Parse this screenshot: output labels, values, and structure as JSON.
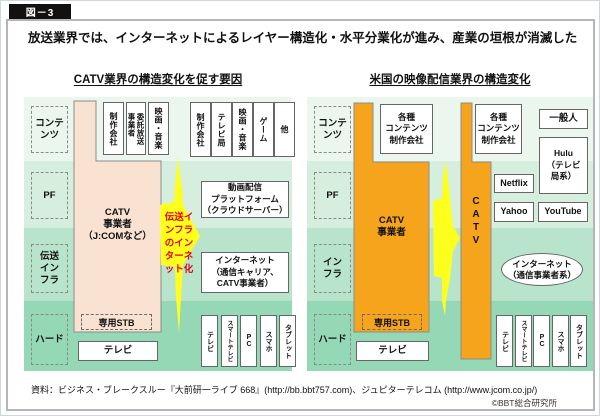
{
  "badge_label": "図－3",
  "title": "放送業界では、インターネットによるレイヤー構造化・水平分業化が進み、産業の垣根が消滅した",
  "colors": {
    "band-content": "#eaf6ee",
    "band-pf": "#d6eede",
    "band-infra": "#b9e4cc",
    "band-hard": "#95d8b5",
    "catv-japan": "#f9e2d1",
    "catv-us": "#f6a41c",
    "arrow": "#ffff1e",
    "arrow-text": "#e60012",
    "badge-bg": "#111111"
  },
  "left_panel": {
    "heading": "CATV業界の構造変化を促す要因",
    "layers": [
      "コンテ\nンツ",
      "PF",
      "伝送\nイン\nフラ",
      "ハード"
    ],
    "boxes_over_catv": [
      "制作会社",
      "委託放送\n事業者",
      "映画・音楽"
    ],
    "content_boxes": [
      "制作会社",
      "テレビ局",
      "映画・音楽",
      "ゲーム",
      "他"
    ],
    "catv_label": "CATV\n事業者\n（J:COMなど）",
    "pf_box": "動画配信\nプラットフォーム\n（クラウドサーバー）",
    "infra_box": "インターネット\n（通信キャリア、\nCATV事業者）",
    "arrow_label": "伝送イ\nンフラ\nのイン\nターネ\nット化",
    "stb_label": "専用STB",
    "tv_label": "テレビ",
    "hard_boxes": [
      "テレビ",
      "スマートテレビ",
      "PC",
      "スマホ",
      "タブレット"
    ]
  },
  "right_panel": {
    "heading": "米国の映像配信業界の構造変化",
    "layers": [
      "コンテ\nンツ",
      "PF",
      "イン\nフラ",
      "ハード"
    ],
    "content_boxes": [
      "各種\nコンテンツ\n制作会社",
      "各種\nコンテンツ\n制作会社",
      "一般人"
    ],
    "catv_label": "CATV\n事業者",
    "catv_bar_label": "CATV",
    "hulu": "Hulu\n（テレビ\n局系）",
    "netflix": "Netflix",
    "yahoo": "Yahoo",
    "youtube": "YouTube",
    "internet_ellipse": "インターネット\n（通信事業者系）",
    "stb_label": "専用STB",
    "tv_label": "テレビ",
    "hard_boxes": [
      "テレビ",
      "スマートテレビ",
      "PC",
      "スマホ",
      "タブレット"
    ]
  },
  "footer": {
    "source": "資料：ビジネス・ブレークスルー『大前研一ライブ 668』(http://bb.bbt757.com)、ジュピターテレコム (http://www.jcom.co.jp/)",
    "copyright": "©BBT総合研究所"
  }
}
